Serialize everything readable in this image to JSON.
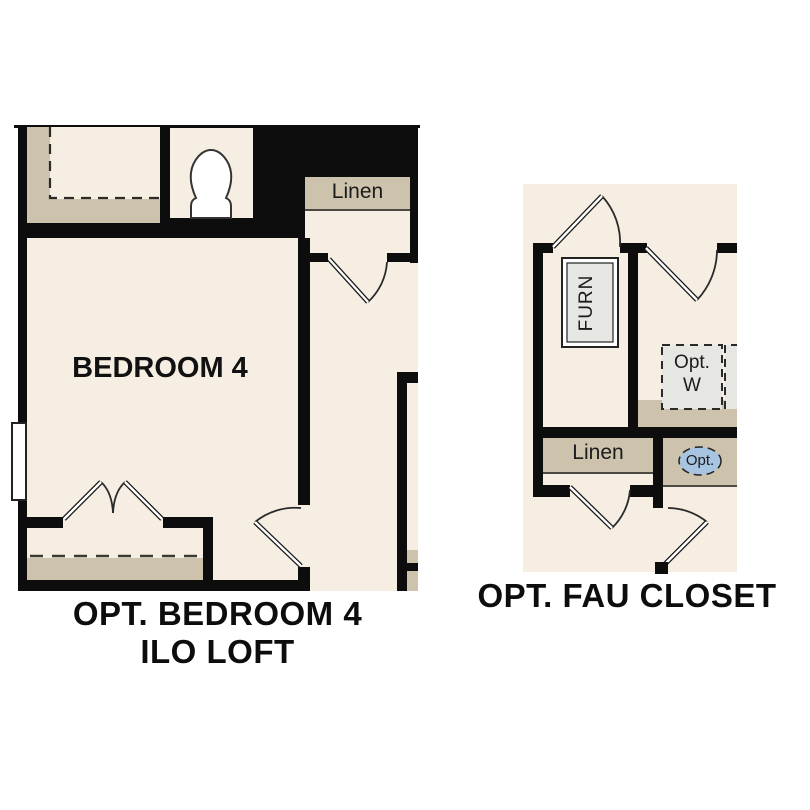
{
  "colors": {
    "background": "#ffffff",
    "wall": "#0d0d0d",
    "floor": "#f6eee2",
    "shelf": "#cdc3ac",
    "fixture_gray": "#e6e6e2",
    "callout_blue": "#a7c4e0"
  },
  "left_plan": {
    "bedroom_label": "BEDROOM 4",
    "linen_label": "Linen",
    "caption_line1": "OPT. BEDROOM 4",
    "caption_line2": "ILO LOFT"
  },
  "right_plan": {
    "furnace_label": "FURN",
    "washer_label_line1": "Opt.",
    "washer_label_line2": "W",
    "linen_label": "Linen",
    "callout_label": "Opt.",
    "caption": "OPT. FAU CLOSET"
  }
}
